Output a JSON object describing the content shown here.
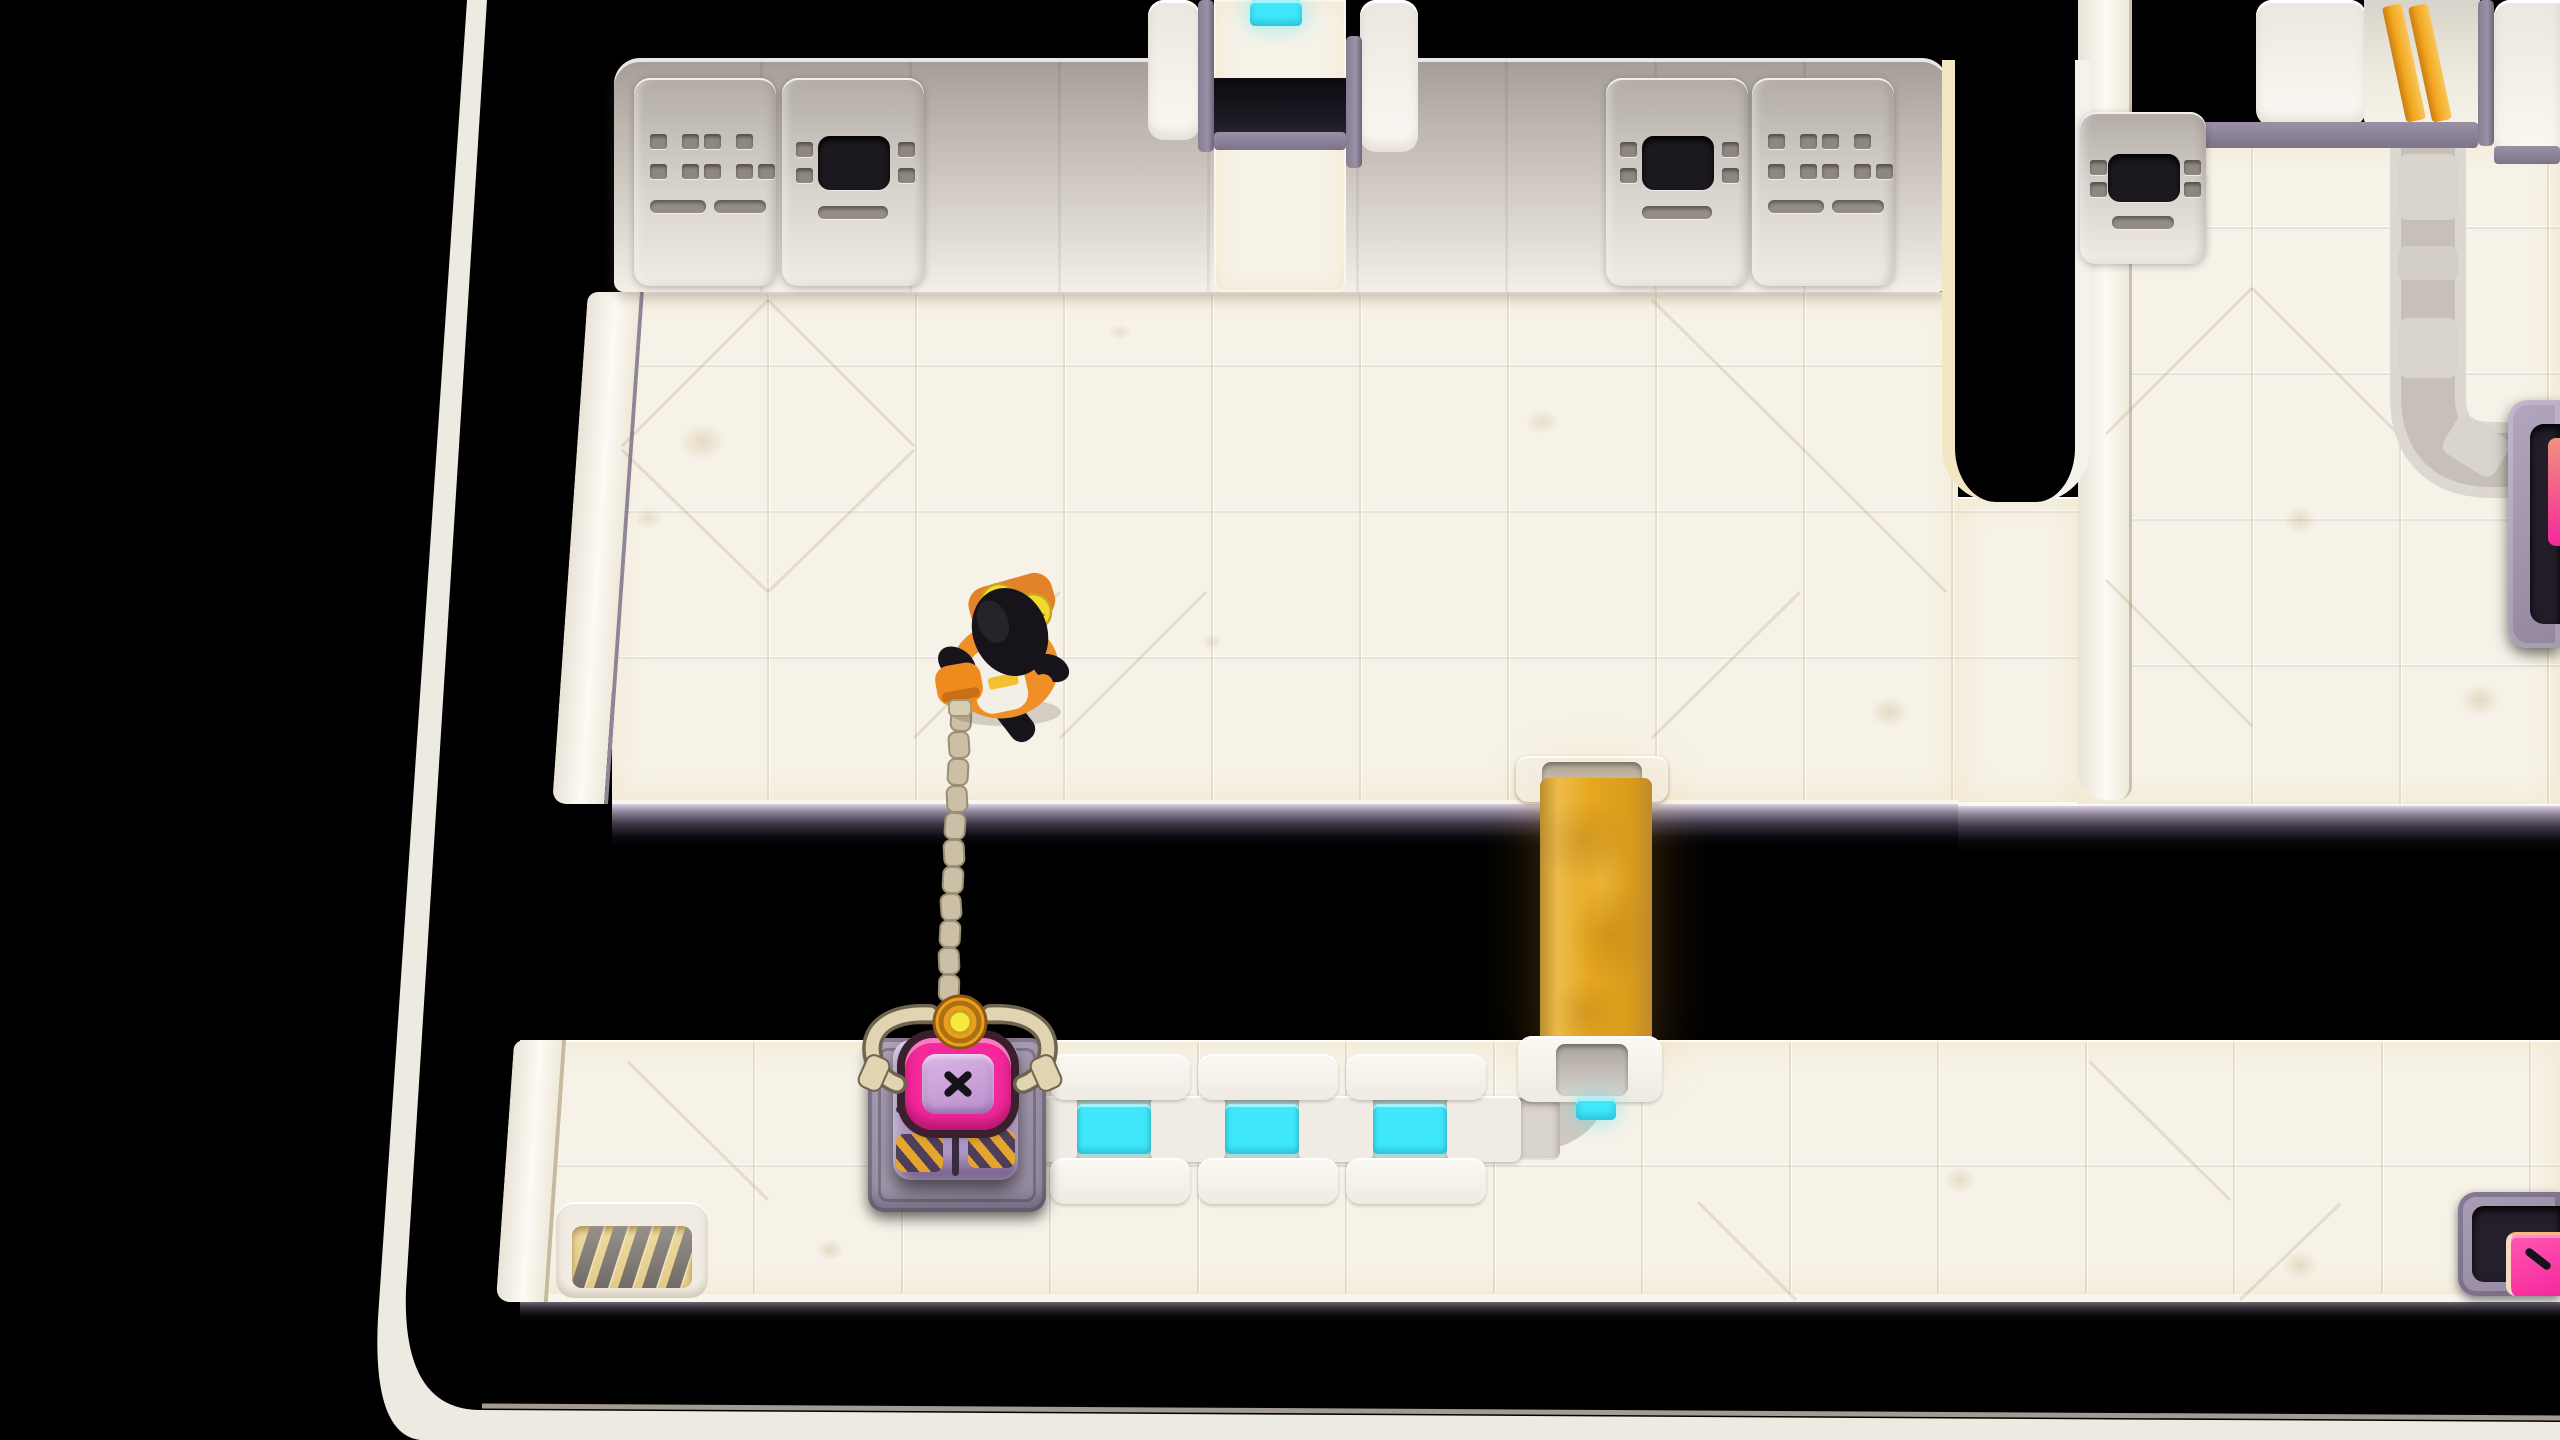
{
  "meta": {
    "app": "isometric sci-fi puzzle game",
    "view": "top-down laboratory level over a black void",
    "visible_text": ""
  },
  "palette": {
    "background": "#000000",
    "floor": "#f6f2e8",
    "rim": "#ede9e1",
    "machine_gray": "#efebe5",
    "screen_black": "#1c191e",
    "trim_purple": "#9b91a7",
    "conveyor_cyan": "#3fe8fa",
    "stream_orange": "#e7a81f",
    "door_stripe_orange": "#f3a61e",
    "crate_purple": "#b29aca",
    "ring_pink": "#f5289c",
    "hazard_orange": "#e8a727",
    "goal_pink": "#f5289c",
    "claw_tan": "#e0d5b0",
    "chain_tan": "#cbbfa6",
    "suit_orange": "#ee8f28",
    "goggle_yellow": "#f3d92b",
    "vest_white": "#f3efe7",
    "grate_amber": "#ecd9a0"
  },
  "objects": {
    "player": {
      "label": "engineer in orange suit with grappling gun",
      "location": "upper room"
    },
    "grapple": {
      "label": "segmented chain with claw",
      "state": "attached to crate",
      "links": 11
    },
    "crate": {
      "label": "purple crate with pink X latch",
      "state": "held by claw on pad"
    },
    "conveyor": {
      "label": "powered conveyor",
      "lit_segments": 3,
      "light_color": "cyan"
    },
    "right_track": {
      "label": "unpowered conveyor track",
      "state": "inactive"
    },
    "stream": {
      "label": "orange stream pouring from upper floor into void"
    },
    "north_doorway": {
      "label": "open doorway with cyan conveyor beyond",
      "state": "open"
    },
    "striped_door": {
      "label": "door with two orange stripes",
      "state": "closed"
    },
    "goal_pad": {
      "label": "delivery pad with pink marker",
      "location": "bottom right"
    },
    "side_machine": {
      "label": "purple receiver machine",
      "location": "right edge"
    },
    "floor_grate": {
      "label": "amber floor vent grate",
      "slats": 5,
      "location": "bottom left"
    },
    "wall_units": {
      "vent_panels": 2,
      "screen_panels": 3
    }
  }
}
